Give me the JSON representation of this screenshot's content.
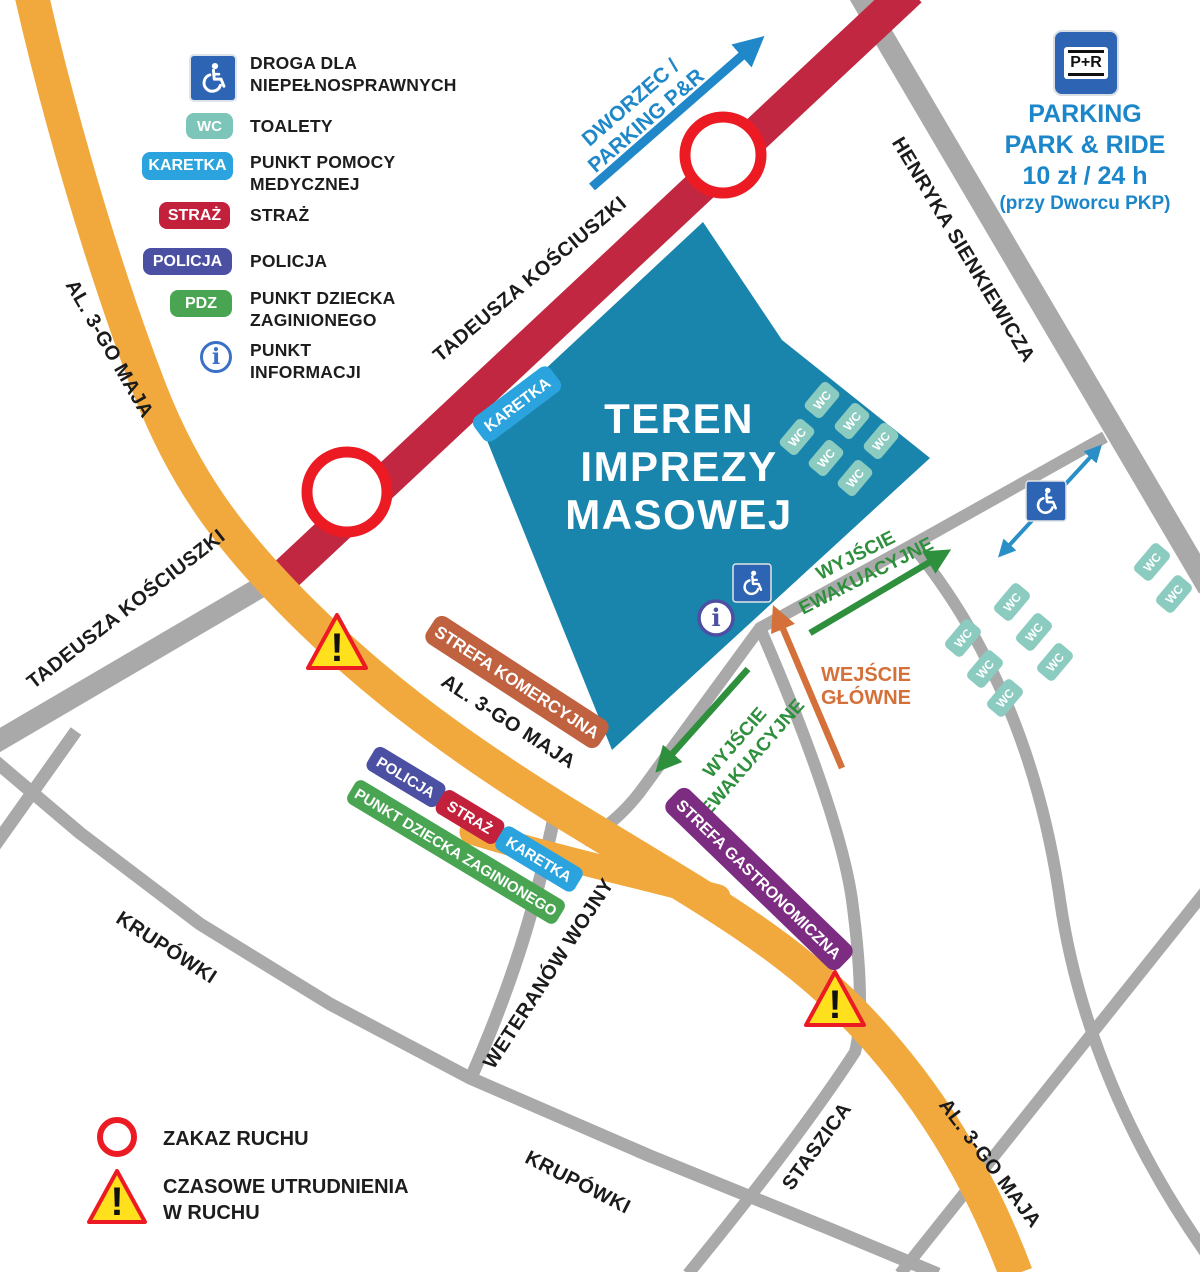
{
  "legend": {
    "items": [
      {
        "type": "icon",
        "icon": "wheelchair-icon",
        "line1": "DROGA DLA",
        "line2": "NIEPEŁNOSPRAWNYCH"
      },
      {
        "type": "badge",
        "badge": "WC",
        "line1": "TOALETY"
      },
      {
        "type": "badge",
        "badge": "KARETKA",
        "line1": "PUNKT POMOCY",
        "line2": "MEDYCZNEJ"
      },
      {
        "type": "badge",
        "badge": "STRAŻ",
        "line1": "STRAŻ"
      },
      {
        "type": "badge",
        "badge": "POLICJA",
        "line1": "POLICJA"
      },
      {
        "type": "badge",
        "badge": "PDZ",
        "line1": "PUNKT DZIECKA",
        "line2": "ZAGINIONEGO"
      },
      {
        "type": "icon",
        "icon": "info-icon",
        "line1": "PUNKT",
        "line2": "INFORMACJI"
      }
    ],
    "info_glyph": "i"
  },
  "parking": {
    "sign": "P+R",
    "line1": "PARKING",
    "line2": "PARK & RIDE",
    "line3": "10 zł / 24 h",
    "line4": "(przy Dworcu PKP)"
  },
  "map": {
    "event_area": {
      "line1": "TEREN",
      "line2": "IMPREZY",
      "line3": "MASOWEJ"
    },
    "streets": {
      "kosciuszki_upper": "TADEUSZA KOŚCIUSZKI",
      "kosciuszki_lower": "TADEUSZA KOŚCIUSZKI",
      "al_3go_maja_top": "AL. 3-GO MAJA",
      "al_3go_maja_mid": "AL. 3-GO MAJA",
      "al_3go_maja_bottom": "AL. 3-GO MAJA",
      "henryka_sienkiewicza": "HENRYKA SIENKIEWICZA",
      "weteranow_wojny": "WETERANÓW WOJNY",
      "krupowki_left": "KRUPÓWKI",
      "krupowki_mid": "KRUPÓWKI",
      "staszica": "STASZICA"
    },
    "arrows": {
      "dworzec": {
        "line1": "DWORZEC /",
        "line2": "PARKING P&R"
      },
      "evac": {
        "line1": "WYJŚCIE",
        "line2": "EWAKUACYJNE"
      },
      "main_entrance": {
        "line1": "WEJŚCIE",
        "line2": "GŁÓWNE"
      }
    },
    "zones": {
      "commercial": "STREFA KOMERCYJNA",
      "gastronomy": "STREFA GASTRONOMICZNA"
    },
    "badges": {
      "karetka_area": "KARETKA",
      "policja": "POLICJA",
      "straz": "STRAŻ",
      "karetka_fork": "KARETKA",
      "pdz": "PUNKT DZIECKA ZAGINIONEGO"
    },
    "wc": "WC",
    "warning_glyph": "!",
    "info_glyph": "i"
  },
  "footer": {
    "zakaz": "ZAKAZ RUCHU",
    "czasowe_line1": "CZASOWE UTRUDNIENIA",
    "czasowe_line2": "W RUCHU"
  },
  "colors": {
    "road_orange": "#f1a93e",
    "road_red": "#c12741",
    "road_gray": "#a9a9a9",
    "event_area_blue": "#1a85ac",
    "karetka_blue": "#2aa3de",
    "wc_teal": "#7dc5b9",
    "straz_red": "#c3203c",
    "policja_indigo": "#4c50a3",
    "pdz_green": "#4aa553",
    "commercial_terracotta": "#c06140",
    "gastronomy_purple": "#7c2d82",
    "evac_green": "#2e8f3d",
    "entrance_orange": "#d4703a",
    "link_blue": "#2088c8",
    "alert_red": "#ec1b23",
    "warning_yellow": "#ffe01c",
    "parking_blue": "#1b86c9",
    "sign_blue": "#2d64b3"
  }
}
